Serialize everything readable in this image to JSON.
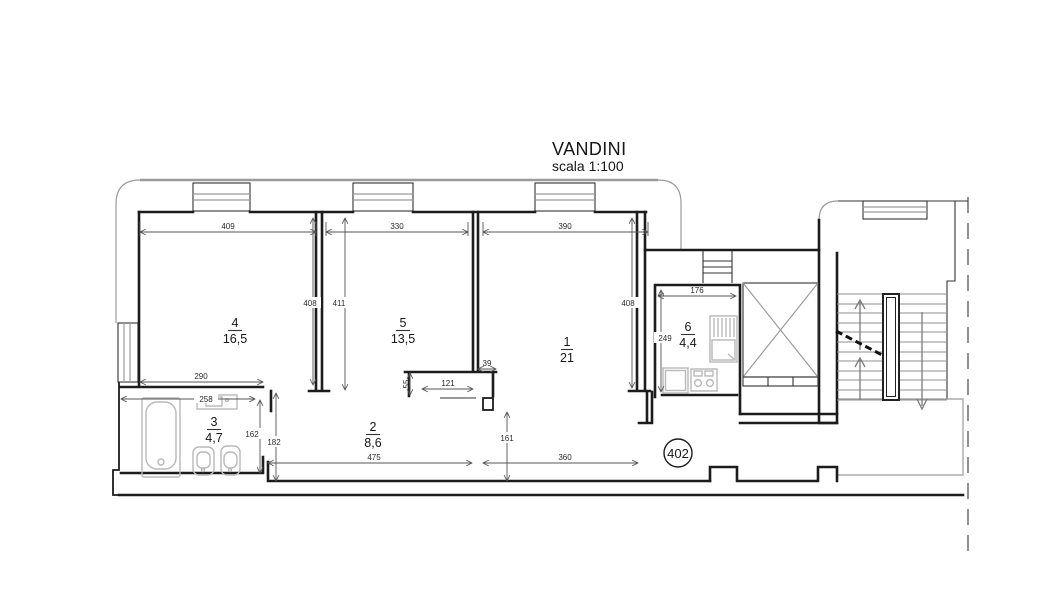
{
  "title": {
    "name": "VANDINI",
    "scale": "scala 1:100"
  },
  "unit": {
    "number": "402"
  },
  "rooms": [
    {
      "id": "1",
      "area": "21"
    },
    {
      "id": "2",
      "area": "8,6"
    },
    {
      "id": "3",
      "area": "4,7"
    },
    {
      "id": "4",
      "area": "16,5"
    },
    {
      "id": "5",
      "area": "13,5"
    },
    {
      "id": "6",
      "area": "4,4"
    }
  ],
  "dims": {
    "w_room4": "409",
    "w_room5": "330",
    "w_room1": "390",
    "h_room4": "408",
    "h_room5": "411",
    "h_room1": "408",
    "w_kitchen": "176",
    "h_kitchen": "249",
    "w_room4_lower": "290",
    "w_bath": "258",
    "h_bath": "162",
    "h_bath_wall": "182",
    "w_stub": "39",
    "w_room5_door": "121",
    "h_stub": "55",
    "h_hall": "161",
    "w_hall": "475",
    "w_hall_right": "360"
  },
  "colors": {
    "wall": "#1c1c1c",
    "boundary": "#9b9b9b",
    "fixture": "#b8b8b8",
    "dimension": "#555555"
  }
}
